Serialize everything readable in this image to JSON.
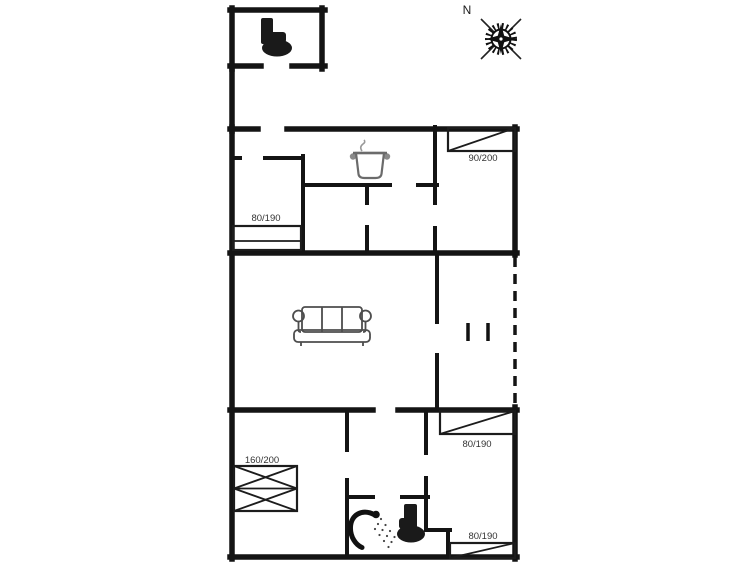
{
  "plan": {
    "title": "holiday-house-floor-plan",
    "compass_label": "N",
    "beds": [
      {
        "id": "bed-top-right",
        "size_label": "90/200"
      },
      {
        "id": "bed-top-left",
        "size_label": "80/190"
      },
      {
        "id": "bed-double-bottom-left",
        "size_label": "160/200"
      },
      {
        "id": "bed-bottom-right-upper",
        "size_label": "80/190"
      },
      {
        "id": "bed-bottom-right-lower",
        "size_label": "80/190"
      }
    ],
    "icons": [
      "toilet-icon-annex",
      "stove-pot-icon",
      "sofa-icon",
      "shower-icon",
      "toilet-icon-bathroom",
      "compass-rose-icon"
    ],
    "colors": {
      "walls": "#141414",
      "background": "#ffffff",
      "label_text": "#333333"
    }
  }
}
